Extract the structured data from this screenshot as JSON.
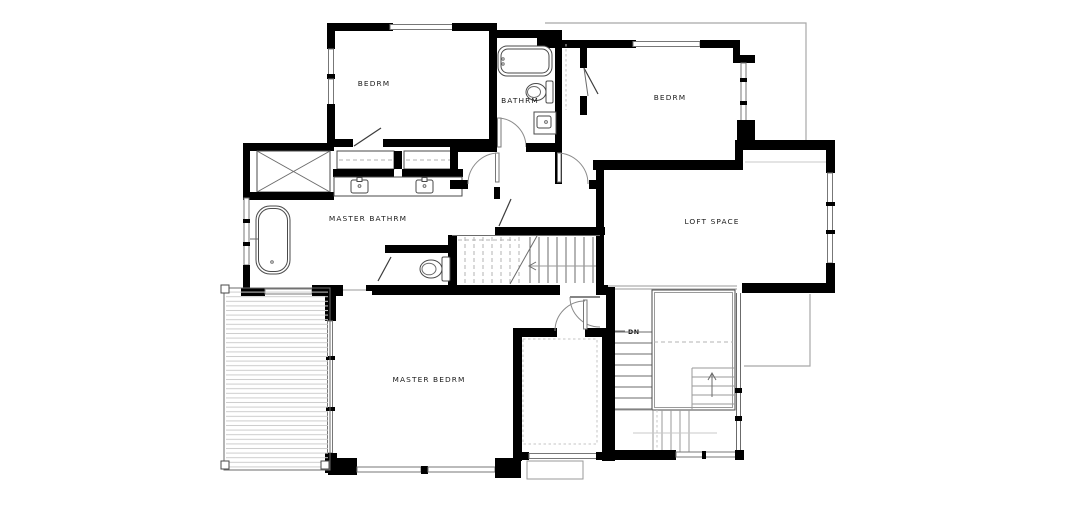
{
  "drawing": {
    "type": "architectural-floor-plan",
    "background_color": "#ffffff",
    "colors": {
      "wall": "#000000",
      "thin_line": "#6b6b6b",
      "light_line": "#c8c8c8",
      "dashed_line": "#b3b3b3",
      "roof_outline": "#a8a8a8",
      "label_text": "#1b1b1b"
    },
    "rooms": [
      {
        "id": "bedroom-1",
        "label": "BEDRM"
      },
      {
        "id": "bathroom",
        "label": "BATHRM"
      },
      {
        "id": "bedroom-2",
        "label": "BEDRM"
      },
      {
        "id": "master-bathroom",
        "label": "MASTER BATHRM"
      },
      {
        "id": "loft",
        "label": "LOFT SPACE"
      },
      {
        "id": "master-bedroom",
        "label": "MASTER BEDRM"
      }
    ],
    "stairs": {
      "down_label": "DN"
    },
    "fixtures": [
      "bathtub",
      "toilet",
      "vanity-sink",
      "freestanding-tub",
      "double-vanity-sinks",
      "water-closet-toilet",
      "linen-x-box",
      "closet-rods",
      "deck-planks",
      "stair-treads",
      "windows",
      "door-swings"
    ]
  }
}
